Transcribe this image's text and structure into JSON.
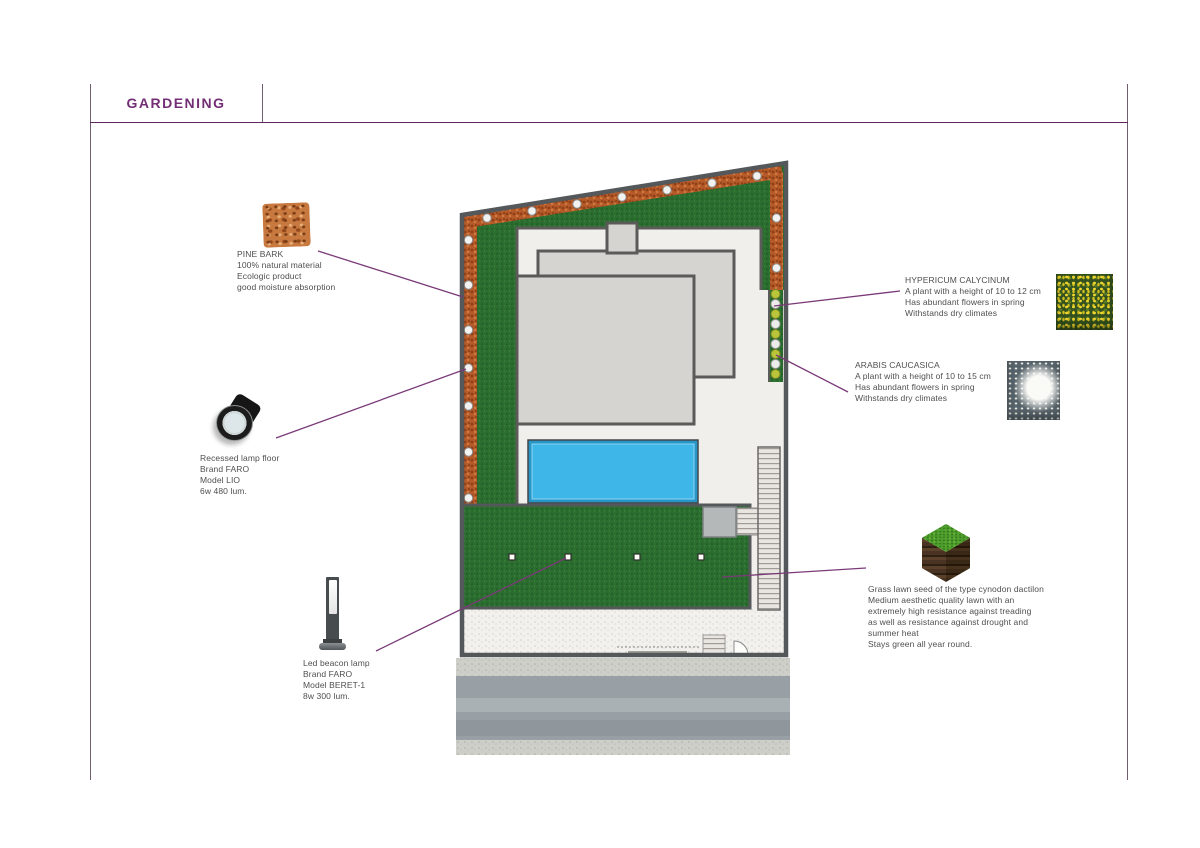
{
  "page": {
    "title": "GARDENING"
  },
  "annotations": {
    "pine_bark": {
      "name": "PINE BARK",
      "desc": [
        "100% natural material",
        "Ecologic product",
        "good moisture absorption"
      ]
    },
    "recessed_lamp": {
      "desc": [
        "Recessed lamp floor",
        "Brand FARO",
        "Model LIO",
        "6w 480 lum."
      ]
    },
    "led_beacon_lamp": {
      "desc": [
        "Led beacon lamp",
        "Brand FARO",
        "Model BERET-1",
        "8w 300 lum."
      ]
    },
    "hypericum": {
      "name": "HYPERICUM CALYCINUM",
      "desc": [
        "A plant with a height of 10 to 12 cm",
        "Has abundant flowers in spring",
        "Withstands dry climates"
      ]
    },
    "arabis": {
      "name": "ARABIS CAUCASICA",
      "desc": [
        "A plant with a height of 10 to 15 cm",
        "Has abundant flowers in spring",
        "Withstands dry climates"
      ]
    },
    "grass_lawn": {
      "desc": [
        "Grass lawn seed of the type cynodon dactilon",
        "Medium aesthetic quality lawn with an",
        "extremely high resistance against treading",
        "as well as resistance against drought and",
        "summer heat",
        "Stays green all year round."
      ]
    }
  },
  "colors": {
    "accent_purple": "#732f75",
    "leader_line": "#7a3a78",
    "lawn_green": "#2c6e2f",
    "bark_orange": "#b55a28",
    "pool_blue": "#3eb7e8",
    "wall_gray": "#54585a"
  }
}
